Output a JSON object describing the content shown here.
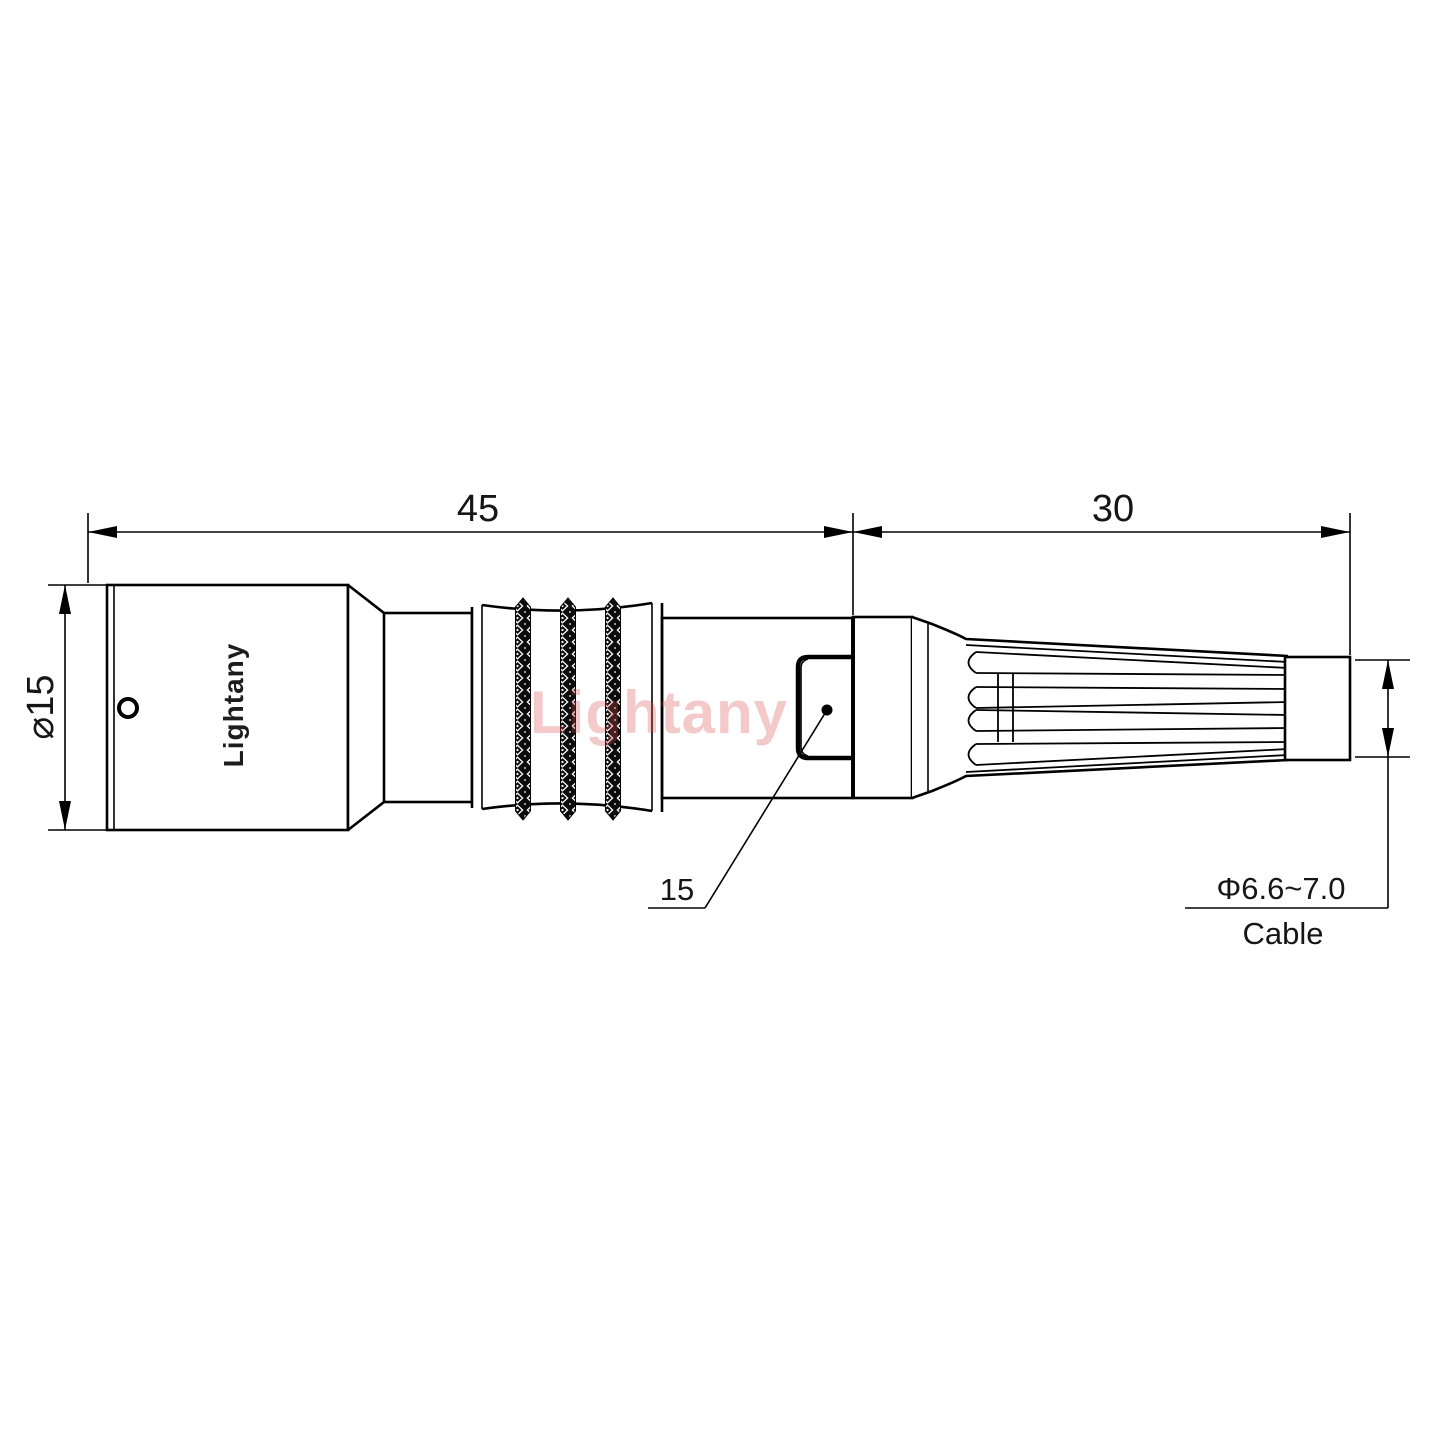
{
  "drawing": {
    "brand_label": "Lightany",
    "watermark_text": "Lightany",
    "dimensions": {
      "front_length": "45",
      "boot_length": "30",
      "body_diameter": "⌀15",
      "latch_position": "15",
      "cable_diameter": "Φ6.6~7.0",
      "cable_label": "Cable"
    },
    "colors": {
      "line": "#000000",
      "watermark": "rgba(214,76,76,0.30)",
      "background": "#ffffff"
    }
  }
}
